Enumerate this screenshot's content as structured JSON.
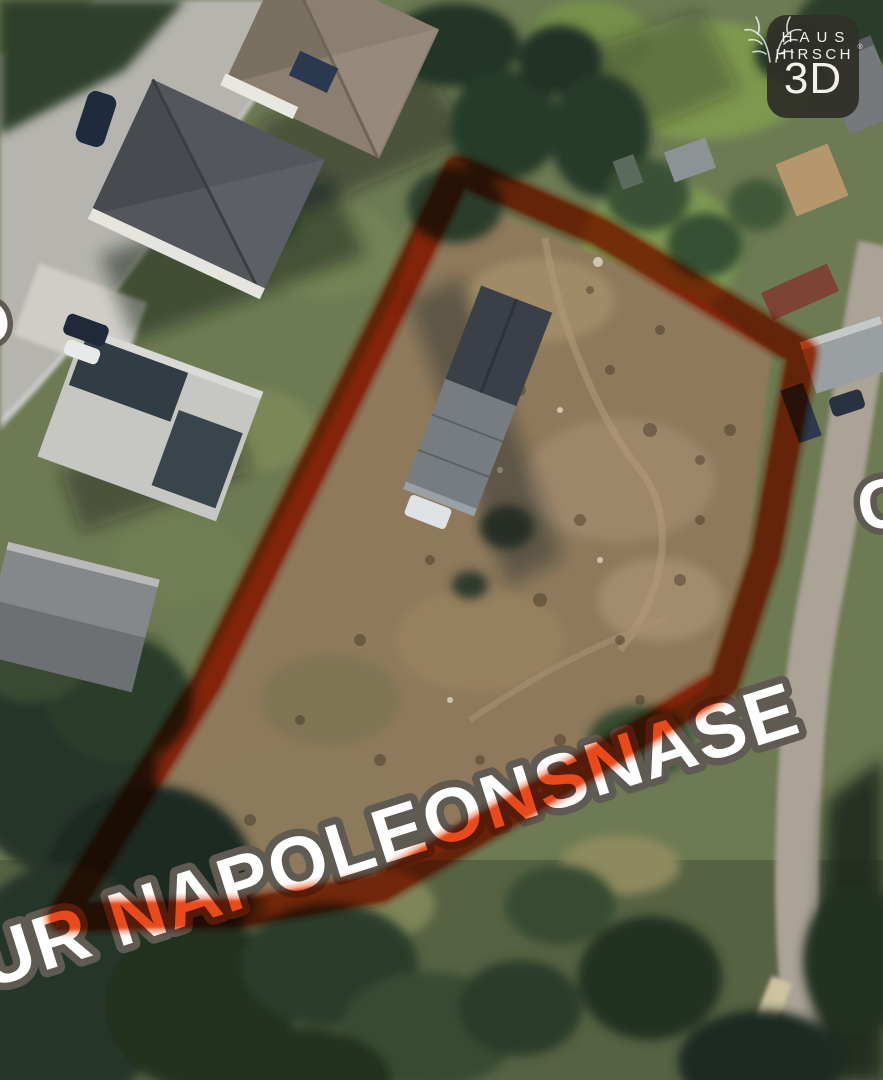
{
  "logo": {
    "line1": "HAUS",
    "line2": "HIRSCH",
    "trademark": "®",
    "line3": "3D"
  },
  "map": {
    "street_label": "ZUR NAPOLEONSNASE",
    "partial_street_letter_right": "C",
    "partial_street_letter_left": "O",
    "boundary_color": "#e63405",
    "street_label_fill": "#ffffff",
    "street_label_outline": "#5f5a52"
  }
}
